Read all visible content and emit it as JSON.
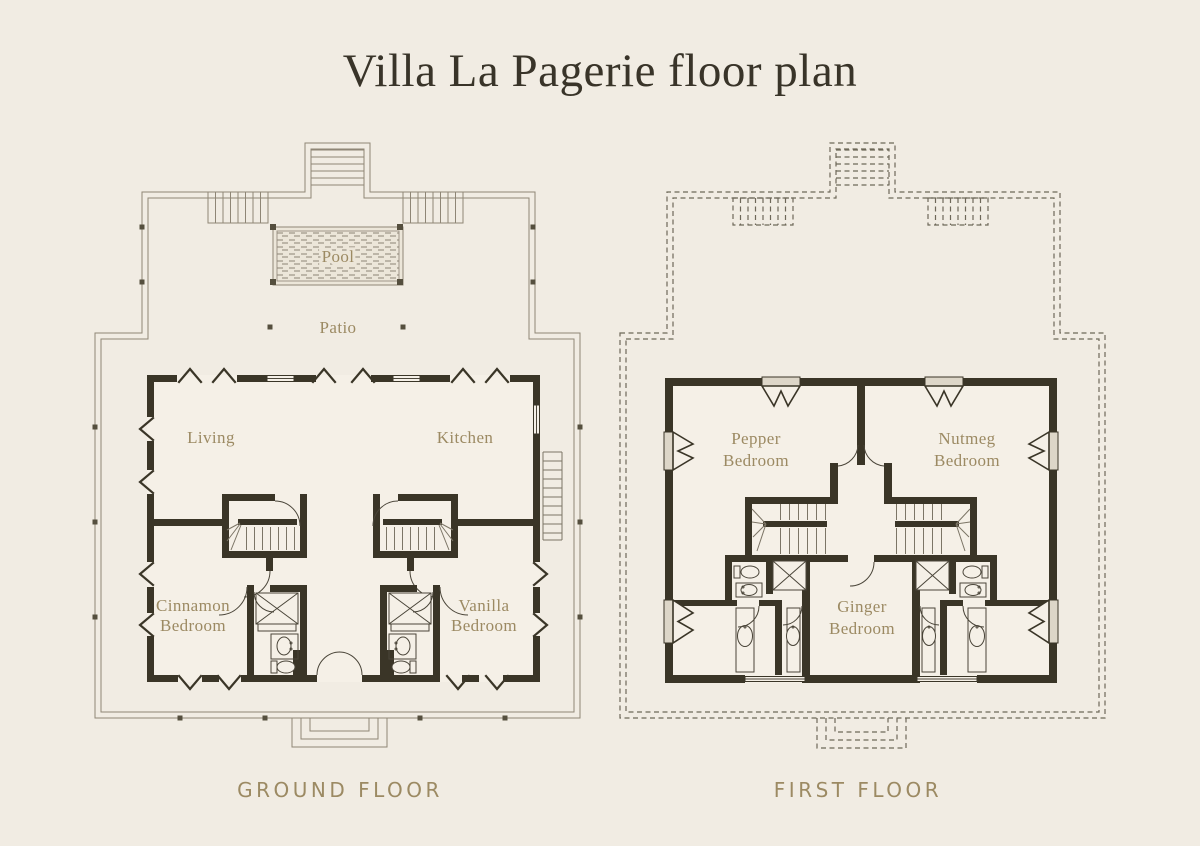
{
  "title": "Villa La Pagerie floor plan",
  "colors": {
    "bg": "#f1ece3",
    "floor": "#f5f0e7",
    "wall": "#3a3527",
    "accent": "#9c8a63",
    "title-ink": "#393429",
    "line": "#8f8676",
    "fixline": "#4a4539",
    "stair": "#7c7566",
    "dash": "#6e6859",
    "sill": "#ddd6c8"
  },
  "ground": {
    "caption": "GROUND FLOOR",
    "pool": "Pool",
    "patio": "Patio",
    "rooms": {
      "living": "Living",
      "kitchen": "Kitchen",
      "cinnamon1": "Cinnamon",
      "cinnamon2": "Bedroom",
      "vanilla1": "Vanilla",
      "vanilla2": "Bedroom"
    }
  },
  "first": {
    "caption": "FIRST FLOOR",
    "rooms": {
      "pepper1": "Pepper",
      "pepper2": "Bedroom",
      "nutmeg1": "Nutmeg",
      "nutmeg2": "Bedroom",
      "ginger1": "Ginger",
      "ginger2": "Bedroom"
    }
  }
}
